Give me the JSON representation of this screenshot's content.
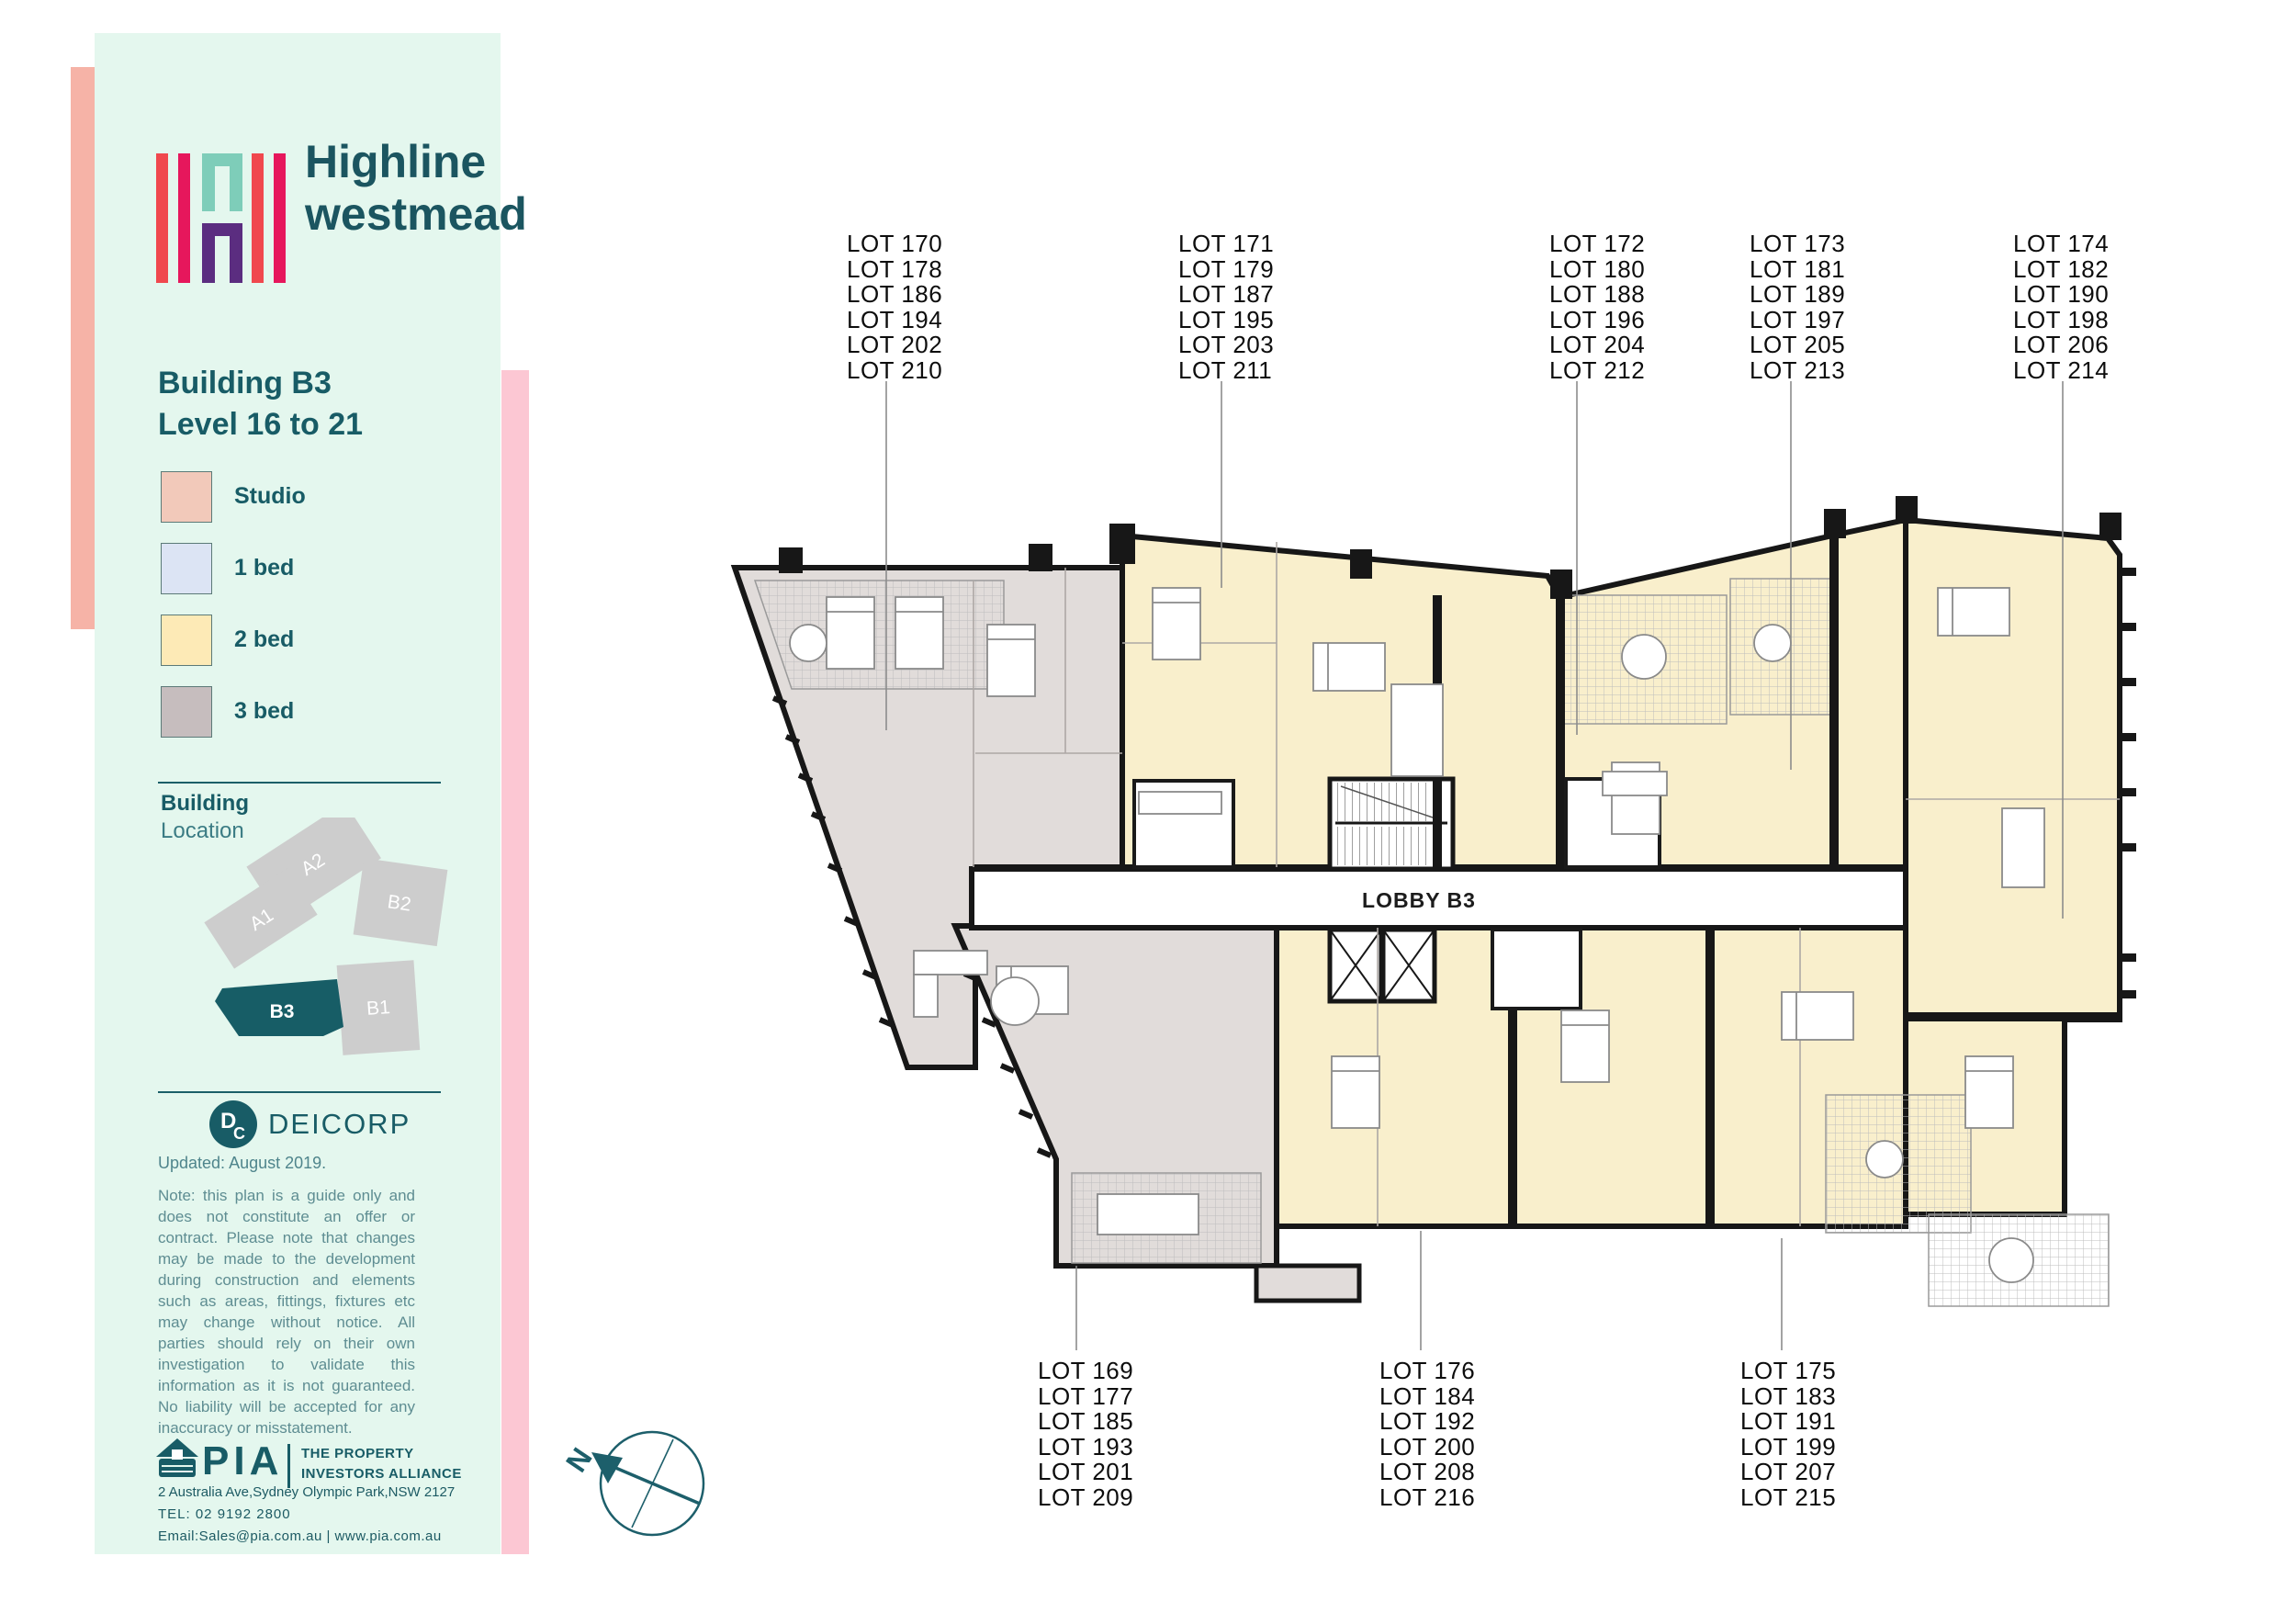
{
  "sidebar": {
    "logo": {
      "brand_line1": "Highline",
      "brand_line2": "westmead"
    },
    "title_line1": "Building B3",
    "title_line2": "Level",
    "title_range": "16 to 21",
    "legend": [
      {
        "label": "Studio",
        "color": "#f2c9ba"
      },
      {
        "label": "1 bed",
        "color": "#dce4f4"
      },
      {
        "label": "2 bed",
        "color": "#fdeab6"
      },
      {
        "label": "3 bed",
        "color": "#c6bdbe"
      }
    ],
    "building_location": {
      "heading1": "Building",
      "heading2": "Location",
      "buildings": [
        "A2",
        "A1",
        "B1",
        "B2",
        "B3"
      ],
      "highlighted": "B3"
    },
    "deicorp_label": "DEICORP",
    "deicorp_mark": "DC",
    "updated": "Updated: August 2019.",
    "note": "Note: this plan is a guide only and does not constitute an offer or contract. Please note that changes may be made to the development during construction and elements such as areas, fittings, fixtures etc may change without notice. All parties should rely on their own investigation to validate this information as it is not guaranteed. No liability will be accepted for any inaccuracy or misstatement.",
    "pia": {
      "name": "PIA",
      "tagline1": "THE PROPERTY",
      "tagline2": "INVESTORS ALLIANCE",
      "address": "2 Australia Ave,Sydney Olympic Park,NSW 2127",
      "tel": "TEL: 02 9192 2800",
      "email_line": "Email:Sales@pia.com.au  |  www.pia.com.au"
    }
  },
  "plan": {
    "lobby_label": "LOBBY B3",
    "compass_label": "N",
    "colors": {
      "two_bed_fill": "#f9efcc",
      "three_bed_fill": "#e1dcda",
      "wall": "#171717",
      "mint": "#e4f7ee",
      "salmon_accent": "#f6b3a7",
      "pink_accent": "#fcc7d3",
      "teal": "#185c66"
    },
    "top_groups": [
      {
        "lots": [
          "LOT 170",
          "LOT 178",
          "LOT 186",
          "LOT 194",
          "LOT 202",
          "LOT 210"
        ]
      },
      {
        "lots": [
          "LOT 171",
          "LOT 179",
          "LOT 187",
          "LOT 195",
          "LOT 203",
          "LOT 211"
        ]
      },
      {
        "lots": [
          "LOT 172",
          "LOT 180",
          "LOT 188",
          "LOT 196",
          "LOT 204",
          "LOT 212"
        ]
      },
      {
        "lots": [
          "LOT 173",
          "LOT 181",
          "LOT 189",
          "LOT 197",
          "LOT 205",
          "LOT 213"
        ]
      },
      {
        "lots": [
          "LOT 174",
          "LOT 182",
          "LOT 190",
          "LOT 198",
          "LOT 206",
          "LOT 214"
        ]
      }
    ],
    "bottom_groups": [
      {
        "lots": [
          "LOT 169",
          "LOT 177",
          "LOT 185",
          "LOT 193",
          "LOT 201",
          "LOT 209"
        ]
      },
      {
        "lots": [
          "LOT 176",
          "LOT 184",
          "LOT 192",
          "LOT 200",
          "LOT 208",
          "LOT 216"
        ]
      },
      {
        "lots": [
          "LOT 175",
          "LOT 183",
          "LOT 191",
          "LOT 199",
          "LOT 207",
          "LOT 215"
        ]
      }
    ]
  }
}
